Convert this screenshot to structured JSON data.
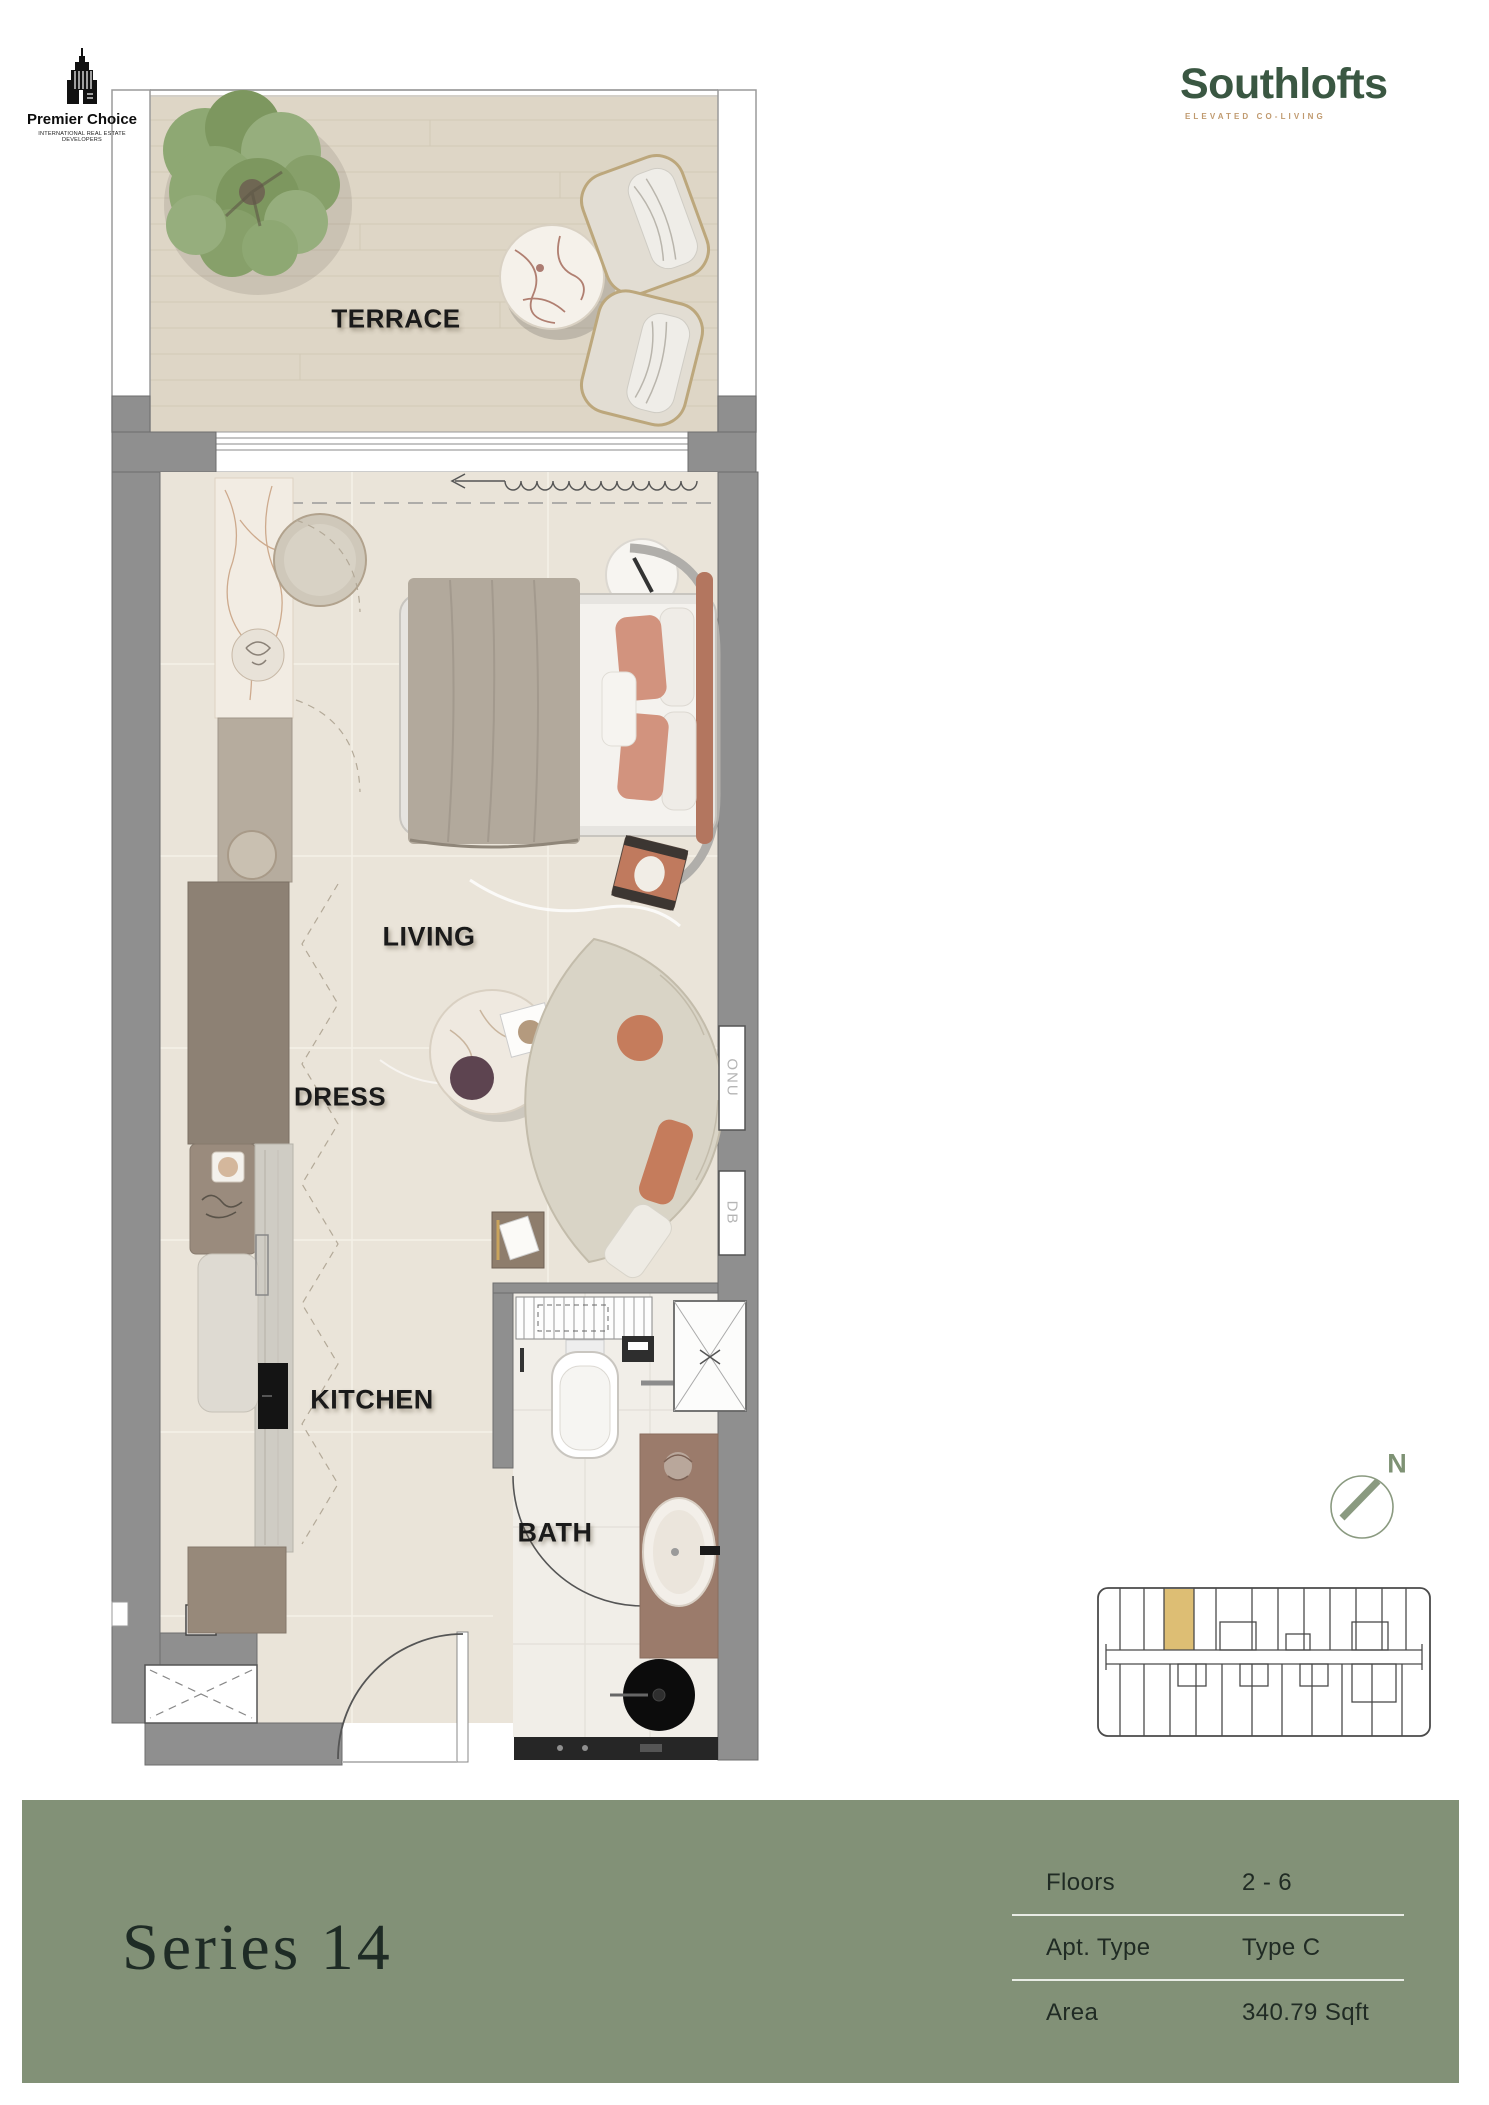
{
  "branding": {
    "premier_choice": {
      "name": "Premier Choice",
      "tagline": "INTERNATIONAL REAL ESTATE DEVELOPERS"
    },
    "southlofts": {
      "name": "Southlofts",
      "tagline": "ELEVATED CO-LIVING"
    }
  },
  "floorplan": {
    "labels": {
      "terrace": "TERRACE",
      "living": "LIVING",
      "dress": "DRESS",
      "kitchen": "KITCHEN",
      "bath": "BATH",
      "onu": "ONU",
      "db": "DB"
    },
    "compass": {
      "north": "N"
    }
  },
  "footer": {
    "series_title": "Series 14",
    "details": [
      {
        "label": "Floors",
        "value": "2 - 6"
      },
      {
        "label": "Apt. Type",
        "value": "Type C"
      },
      {
        "label": "Area",
        "value": "340.79 Sqft"
      }
    ]
  },
  "colors": {
    "footer_green": "#829177",
    "accent_gold": "#ddbe74",
    "brand_green": "#3a5742",
    "brand_tan": "#c09a6f",
    "wall_gray": "#8f8f8f",
    "floor_beige": "#eae4d9",
    "terrace_beige": "#ded6c6"
  }
}
